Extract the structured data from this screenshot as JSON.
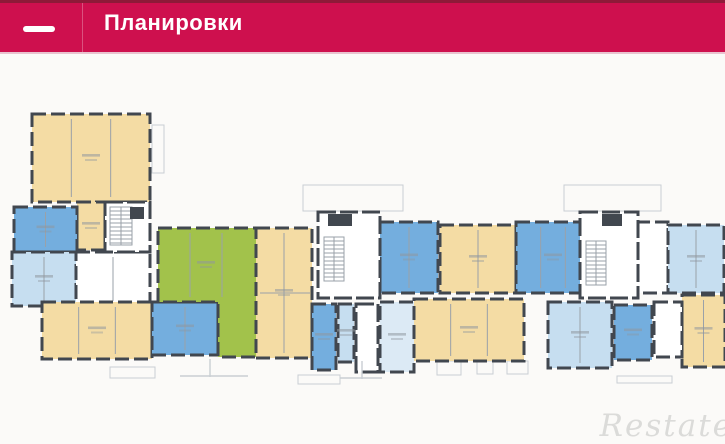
{
  "header": {
    "title": "Планировки"
  },
  "watermark": {
    "text": "Restate"
  },
  "palette": {
    "beige": "#F4DCA4",
    "blue": "#74AEDE",
    "lightblue": "#C6DEF0",
    "paleblue": "#DCEAF5",
    "green": "#A2C24B",
    "white": "#FFFFFF",
    "wall": "#41474F",
    "innerline": "#9AA1A8",
    "outline": "#C9CED3",
    "label": "#8F979E",
    "header_bg": "#CE104E"
  },
  "floor_plan": {
    "units": [
      {
        "name": "apartment-beige-a",
        "color": "beige",
        "x": 22,
        "y": 19,
        "w": 118,
        "h": 88,
        "rooms": 3
      },
      {
        "name": "apartment-beige-a2",
        "color": "beige",
        "x": 67,
        "y": 107,
        "w": 28,
        "h": 48,
        "rooms": 1
      },
      {
        "name": "apartment-blue-b",
        "color": "blue",
        "x": 4,
        "y": 112,
        "w": 63,
        "h": 45,
        "rooms": 2
      },
      {
        "name": "apartment-lightblue-c",
        "color": "lightblue",
        "x": 2,
        "y": 157,
        "w": 64,
        "h": 54,
        "rooms": 2
      },
      {
        "name": "rooms-white-left",
        "color": "white",
        "x": 66,
        "y": 157,
        "w": 74,
        "h": 54,
        "rooms": 2
      },
      {
        "name": "apartment-beige-d",
        "color": "beige",
        "x": 32,
        "y": 207,
        "w": 110,
        "h": 57,
        "rooms": 3
      },
      {
        "name": "apartment-blue-5",
        "color": "blue",
        "x": 142,
        "y": 207,
        "w": 66,
        "h": 53,
        "rooms": 2
      },
      {
        "name": "apartment-green-1",
        "color": "green",
        "points": "148,133 246,133 246,262 208,262 208,207 148,207",
        "lines": [
          {
            "x1": 180,
            "y1": 138,
            "x2": 180,
            "y2": 202
          },
          {
            "x1": 212,
            "y1": 138,
            "x2": 212,
            "y2": 202
          }
        ],
        "lx": 196,
        "ly": 170
      },
      {
        "name": "apartment-beige-3",
        "color": "beige",
        "x": 246,
        "y": 133,
        "w": 56,
        "h": 130,
        "rooms": 2,
        "lines": [
          {
            "x1": 250,
            "y1": 198,
            "x2": 300,
            "y2": 198
          }
        ]
      },
      {
        "name": "apartment-blue-2",
        "color": "blue",
        "x": 370,
        "y": 127,
        "w": 58,
        "h": 71,
        "rooms": 2
      },
      {
        "name": "apartment-beige-4",
        "color": "beige",
        "x": 430,
        "y": 130,
        "w": 76,
        "h": 68,
        "rooms": 2
      },
      {
        "name": "apartment-blue-3",
        "color": "blue",
        "x": 506,
        "y": 127,
        "w": 74,
        "h": 71,
        "rooms": 3
      },
      {
        "name": "rooms-white-right-1",
        "color": "white",
        "x": 626,
        "y": 127,
        "w": 32,
        "h": 71,
        "rooms": 1
      },
      {
        "name": "apartment-lightblue-2",
        "color": "lightblue",
        "x": 658,
        "y": 130,
        "w": 56,
        "h": 68,
        "rooms": 2
      },
      {
        "name": "apartment-beige-5",
        "color": "beige",
        "x": 672,
        "y": 200,
        "w": 43,
        "h": 72,
        "rooms": 2
      },
      {
        "name": "apartment-blue-6",
        "color": "blue",
        "x": 302,
        "y": 209,
        "w": 24,
        "h": 66,
        "rooms": 1
      },
      {
        "name": "apartment-lightblue-5",
        "color": "lightblue",
        "x": 328,
        "y": 209,
        "w": 16,
        "h": 58,
        "rooms": 1
      },
      {
        "name": "apartment-paleblue-1",
        "color": "paleblue",
        "x": 370,
        "y": 207,
        "w": 34,
        "h": 70,
        "rooms": 1
      },
      {
        "name": "apartment-beige-6",
        "color": "beige",
        "x": 404,
        "y": 204,
        "w": 110,
        "h": 62,
        "rooms": 3
      },
      {
        "name": "apartment-lightblue-4",
        "color": "lightblue",
        "x": 538,
        "y": 207,
        "w": 64,
        "h": 66,
        "rooms": 2
      },
      {
        "name": "apartment-blue-4",
        "color": "blue",
        "x": 604,
        "y": 210,
        "w": 38,
        "h": 55,
        "rooms": 1
      },
      {
        "name": "rooms-white-right-2",
        "color": "white",
        "x": 644,
        "y": 207,
        "w": 28,
        "h": 55,
        "rooms": 1
      }
    ],
    "cores": [
      {
        "name": "stair-core-left",
        "x": 95,
        "y": 107,
        "w": 45,
        "h": 50
      },
      {
        "name": "stair-core-mid",
        "x": 308,
        "y": 117,
        "w": 62,
        "h": 86
      },
      {
        "name": "entrance-lobby",
        "x": 346,
        "y": 209,
        "w": 22,
        "h": 68
      },
      {
        "name": "stair-core-right",
        "x": 570,
        "y": 117,
        "w": 58,
        "h": 86
      }
    ],
    "stairs": [
      {
        "x": 100,
        "y": 112,
        "w": 22,
        "h": 38
      },
      {
        "x": 314,
        "y": 142,
        "w": 20,
        "h": 44
      },
      {
        "x": 576,
        "y": 146,
        "w": 20,
        "h": 44
      }
    ],
    "shafts": [
      {
        "x": 318,
        "y": 119,
        "w": 24,
        "h": 12
      },
      {
        "x": 592,
        "y": 119,
        "w": 20,
        "h": 12
      },
      {
        "x": 120,
        "y": 112,
        "w": 14,
        "h": 12
      }
    ],
    "balconies": [
      {
        "x": 293,
        "y": 90,
        "w": 100,
        "h": 26
      },
      {
        "x": 554,
        "y": 90,
        "w": 97,
        "h": 26
      },
      {
        "x": 142,
        "y": 30,
        "w": 12,
        "h": 48
      },
      {
        "x": 100,
        "y": 272,
        "w": 45,
        "h": 11
      },
      {
        "x": 427,
        "y": 266,
        "w": 24,
        "h": 14
      },
      {
        "x": 467,
        "y": 266,
        "w": 16,
        "h": 13
      },
      {
        "x": 497,
        "y": 266,
        "w": 21,
        "h": 13
      },
      {
        "x": 607,
        "y": 281,
        "w": 55,
        "h": 7
      },
      {
        "x": 288,
        "y": 280,
        "w": 42,
        "h": 9
      }
    ],
    "marks": [
      {
        "x1": 170,
        "y1": 281,
        "x2": 238,
        "y2": 281
      },
      {
        "x1": 200,
        "y1": 264,
        "x2": 200,
        "y2": 282
      },
      {
        "x1": 352,
        "y1": 266,
        "x2": 352,
        "y2": 284
      },
      {
        "x1": 330,
        "y1": 283,
        "x2": 372,
        "y2": 283
      }
    ]
  }
}
